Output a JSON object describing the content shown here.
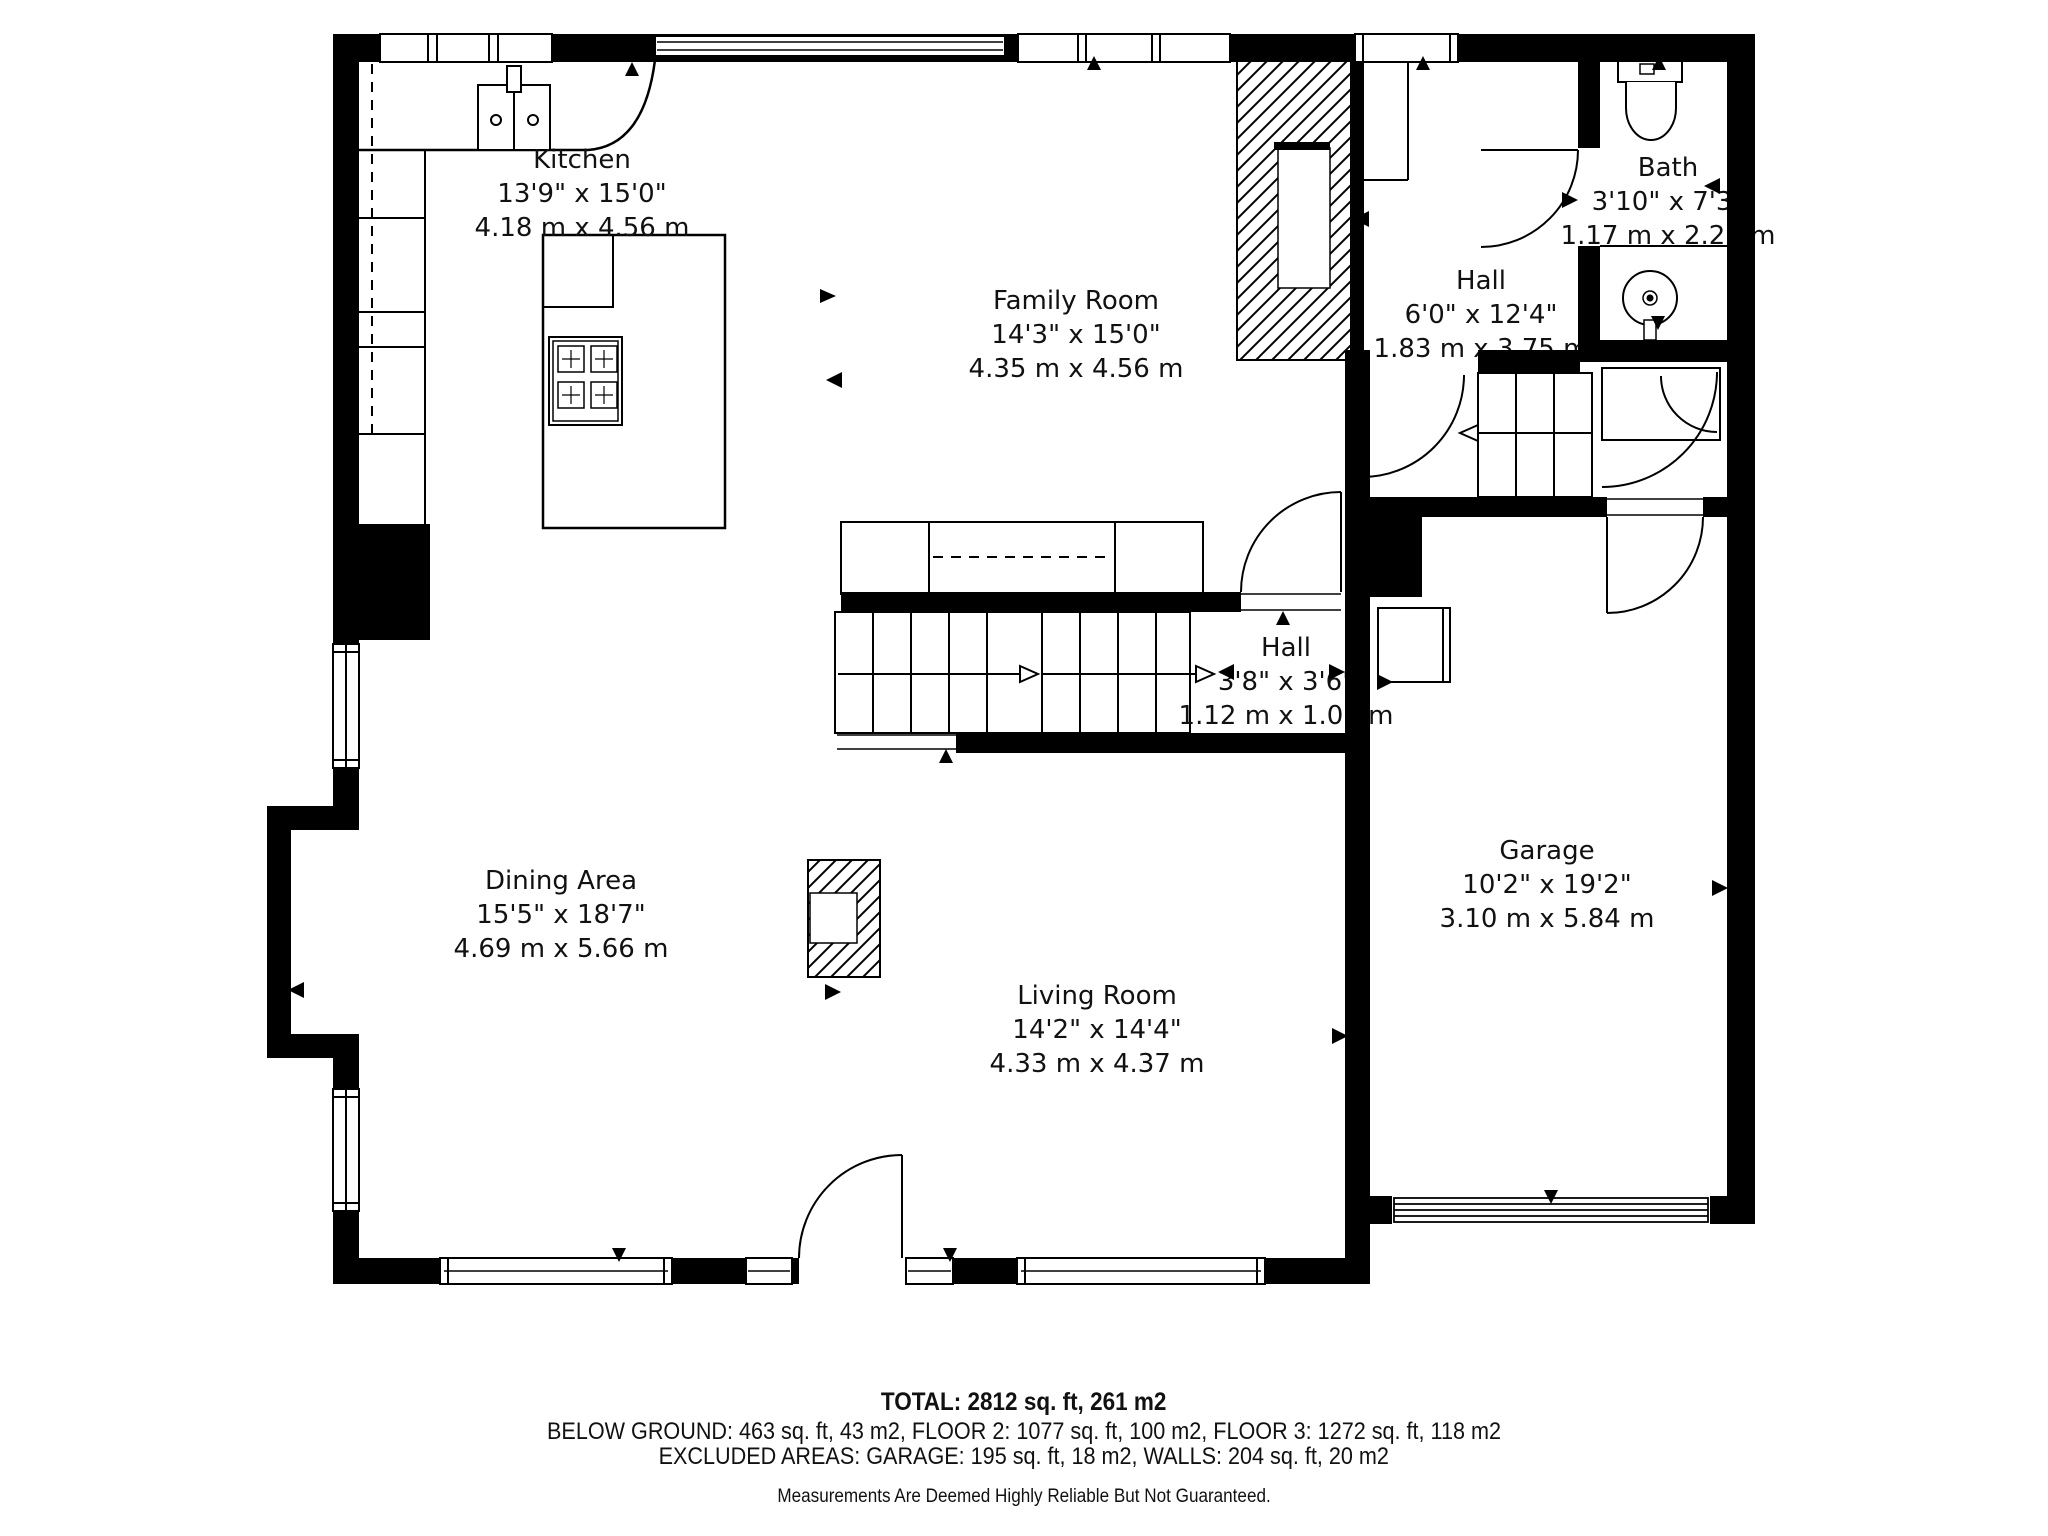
{
  "title": "Floor plan",
  "rooms": [
    {
      "name": "Kitchen",
      "dims_ft": "13'9\" x 15'0\"",
      "dims_m": "4.18 m x 4.56 m"
    },
    {
      "name": "Family Room",
      "dims_ft": "14'3\" x 15'0\"",
      "dims_m": "4.35 m x 4.56 m"
    },
    {
      "name": "Bath",
      "dims_ft": "3'10\" x 7'3\"",
      "dims_m": "1.17 m x 2.21 m"
    },
    {
      "name": "Hall",
      "dims_ft": "6'0\" x 12'4\"",
      "dims_m": "1.83 m x 3.75 m"
    },
    {
      "name": "Hall",
      "dims_ft": "3'8\" x 3'6\"",
      "dims_m": "1.12 m x 1.07 m"
    },
    {
      "name": "Dining Area",
      "dims_ft": "15'5\" x 18'7\"",
      "dims_m": "4.69 m x 5.66 m"
    },
    {
      "name": "Living Room",
      "dims_ft": "14'2\" x 14'4\"",
      "dims_m": "4.33 m x 4.37 m"
    },
    {
      "name": "Garage",
      "dims_ft": "10'2\" x 19'2\"",
      "dims_m": "3.10 m x 5.84 m"
    }
  ],
  "footer": {
    "total": "TOTAL: 2812 sq. ft, 261 m2",
    "floors": "BELOW GROUND: 463 sq. ft, 43 m2, FLOOR 2: 1077 sq. ft, 100 m2, FLOOR 3: 1272 sq. ft, 118 m2",
    "excluded": "EXCLUDED AREAS: GARAGE: 195 sq. ft, 18 m2, WALLS: 204 sq. ft, 20 m2",
    "disclaimer": "Measurements Are Deemed Highly Reliable But Not Guaranteed."
  },
  "colors": {
    "walls": "#000000",
    "background": "#ffffff"
  }
}
